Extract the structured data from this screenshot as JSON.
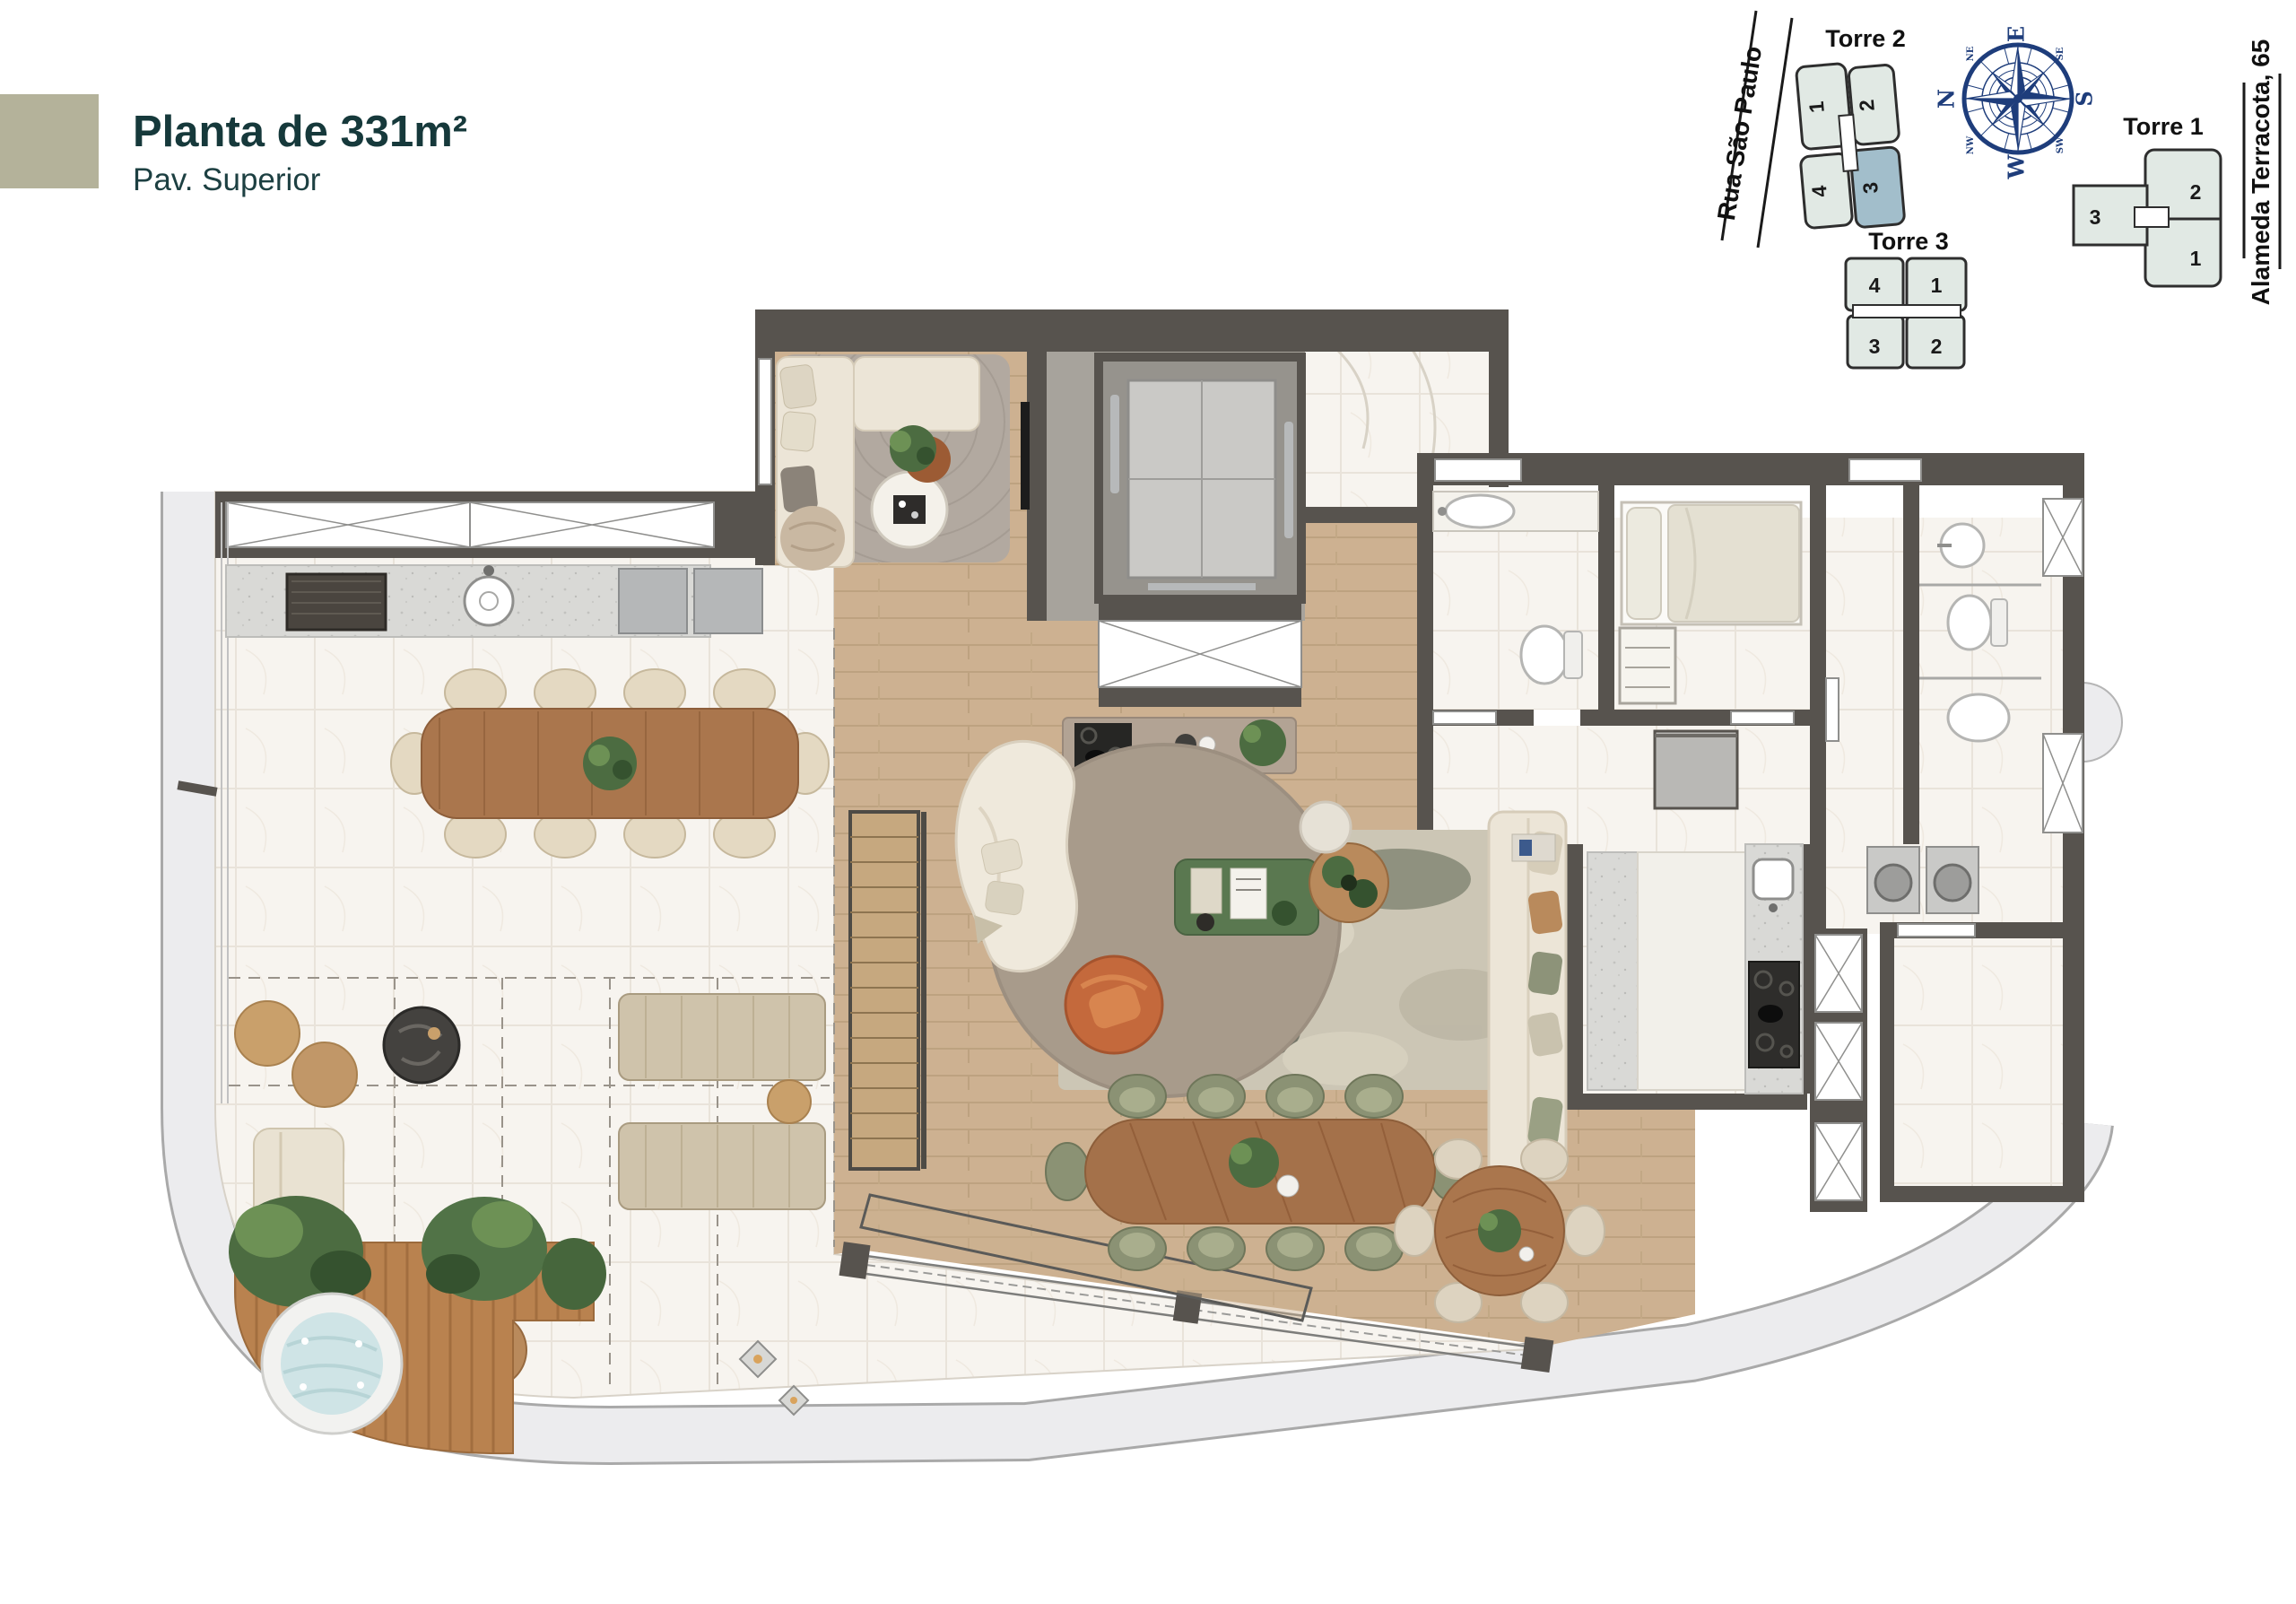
{
  "header": {
    "title": "Planta de 331m²",
    "subtitle": "Pav. Superior",
    "accent_color": "#b4b29a",
    "title_color": "#16393b"
  },
  "site_plan": {
    "street_left": "Rua São Paulo",
    "street_right": "Alameda Terracota, 65",
    "compass": {
      "top": "E",
      "right": "S",
      "bottom": "W",
      "left": "N",
      "top_left": "NE",
      "top_right": "SE",
      "bottom_right": "SW",
      "bottom_left": "NW",
      "north_color": "#e23b2e",
      "rose_color": "#1e3d7b"
    },
    "torre1": {
      "label": "Torre 1",
      "units": [
        "2",
        "3",
        "1"
      ]
    },
    "torre2": {
      "label": "Torre 2",
      "units": [
        "1",
        "2",
        "4",
        "3"
      ],
      "highlighted_unit": "3",
      "highlight_color": "#a2becb",
      "unit_color": "#e1e9e4"
    },
    "torre3": {
      "label": "Torre 3",
      "units": [
        "4",
        "1",
        "3",
        "2"
      ]
    }
  },
  "floor_plan": {
    "wall_color": "#57534e",
    "wood_color": "#cdb191",
    "marble_color": "#f7f4ef",
    "promenade_color": "#ececee",
    "deck_color": "#b9824f",
    "water_color": "#cfe4e6"
  }
}
